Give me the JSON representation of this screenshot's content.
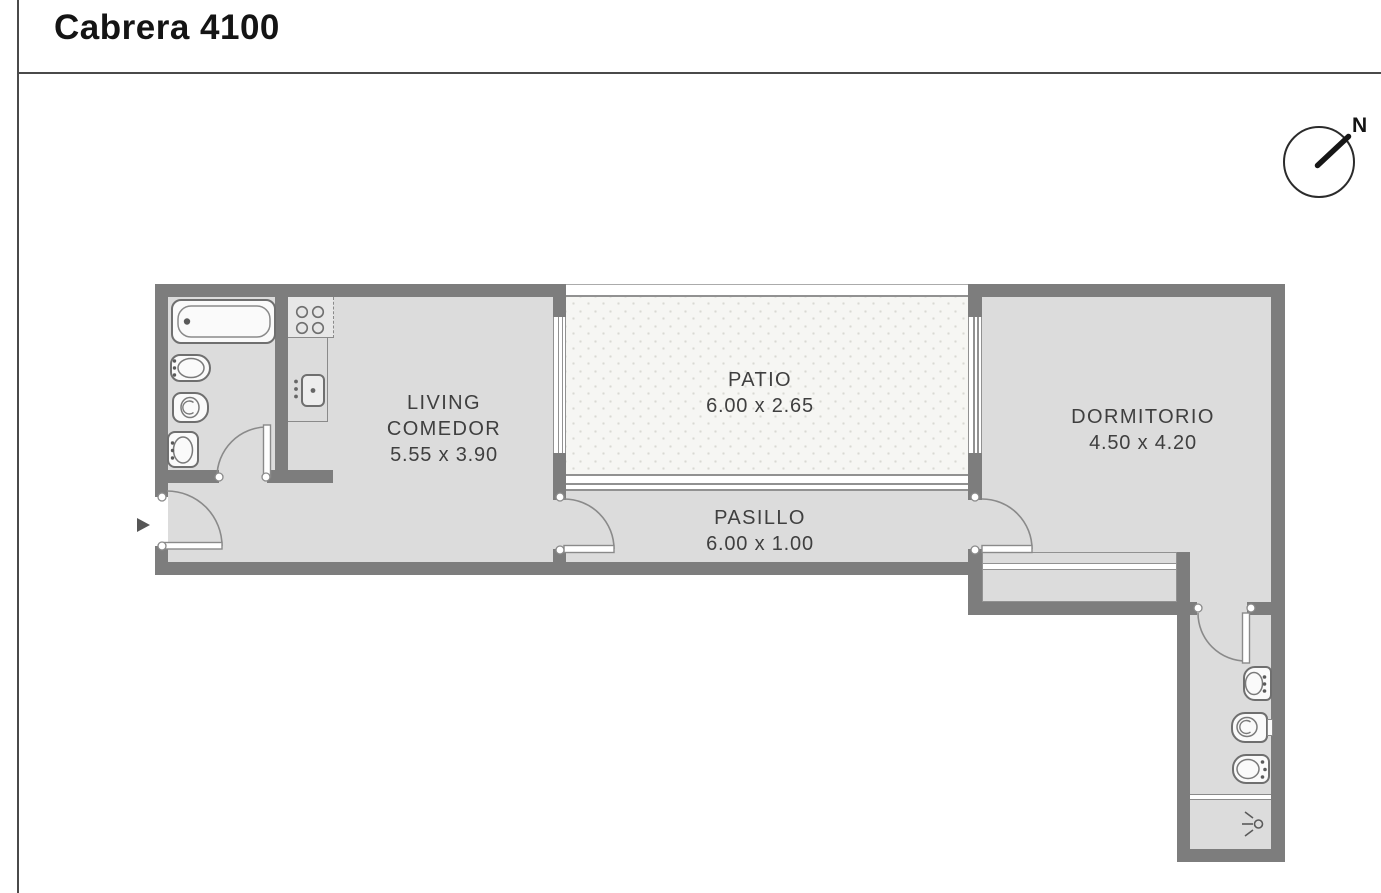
{
  "page": {
    "title": "Cabrera 4100"
  },
  "compass": {
    "label": "N",
    "needle_direction": "north-east"
  },
  "rooms": {
    "living": {
      "name_line1": "LIVING",
      "name_line2": "COMEDOR",
      "dimensions": "5.55 x 3.90"
    },
    "patio": {
      "name": "PATIO",
      "dimensions": "6.00 x 2.65"
    },
    "pasillo": {
      "name": "PASILLO",
      "dimensions": "6.00 x 1.00"
    },
    "dormitorio": {
      "name": "DORMITORIO",
      "dimensions": "4.50 x 4.20"
    }
  },
  "fixtures": {
    "bathroom_main": [
      "bathtub",
      "bidet",
      "toilet",
      "washbasin"
    ],
    "kitchen": [
      "stove-4-burners",
      "kitchen-sink",
      "counter"
    ],
    "bedroom": [
      "closet"
    ],
    "bathroom_secondary": [
      "washbasin",
      "toilet",
      "bidet",
      "shower"
    ]
  },
  "icons": {
    "entrance_marker": "right-triangle-arrow",
    "compass": "circle-with-needle"
  },
  "colors": {
    "wall": "#7d7d7d",
    "floor": "#dcdcdc",
    "patio_floor": "#f6f6f3",
    "outline": "#8a8a8a",
    "text": "#3f3f3f",
    "frame_line": "#4a4a4a"
  }
}
